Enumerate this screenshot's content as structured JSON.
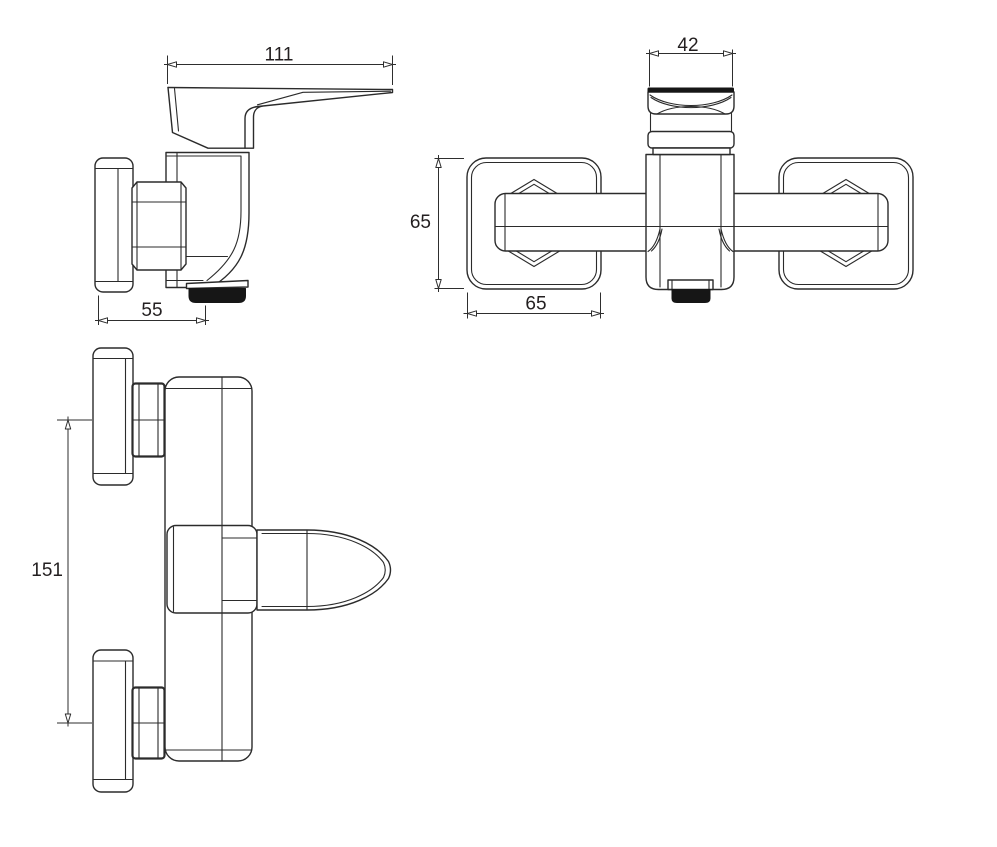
{
  "drawing": {
    "kind": "technical dimension drawing",
    "subject": "wall-mounted single-lever shower mixer tap",
    "background_color": "#ffffff",
    "line_color": "#2b2b2b",
    "dark_fill_color": "#161616",
    "text_color": "#231f20",
    "views": {
      "side": {
        "name": "side view",
        "dims": {
          "overall_length": {
            "value": "111"
          },
          "wall_to_outlet_depth": {
            "value": "55"
          }
        }
      },
      "front": {
        "name": "front view",
        "dims": {
          "handle_width": {
            "value": "42"
          },
          "escutcheon_height": {
            "value": "65"
          },
          "escutcheon_width": {
            "value": "65"
          }
        }
      },
      "top": {
        "name": "top view",
        "dims": {
          "connection_centers_spacing": {
            "value": "151"
          }
        }
      }
    }
  }
}
